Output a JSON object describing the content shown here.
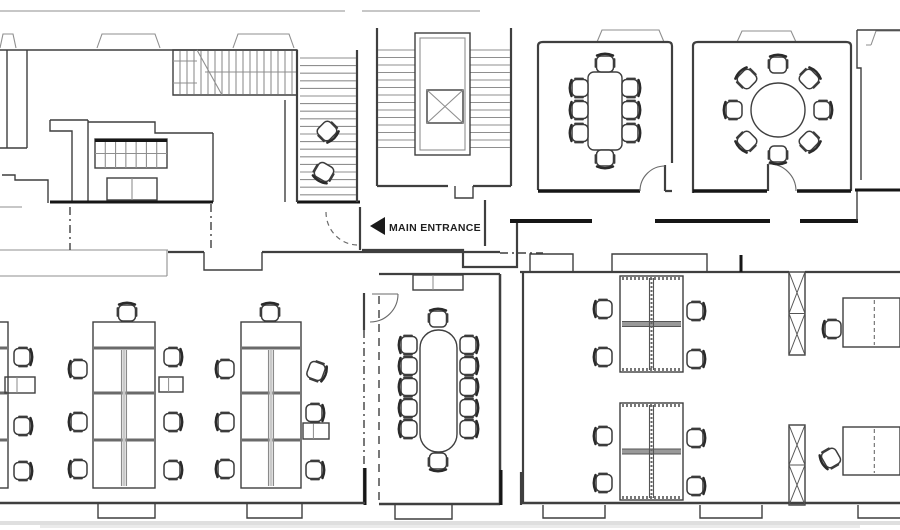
{
  "labels": {
    "main_entrance": "MAIN ENTRANCE"
  },
  "colors": {
    "background": "#ffffff",
    "wall": "#3f3f3f",
    "wall_dark": "#161616",
    "line_light": "#8f8f8f",
    "furniture": "#3c3c3c",
    "text": "#1f1f1f",
    "scan_shadow": "#bfbfbf"
  },
  "floorplan": {
    "chairs": [
      [
        605,
        64,
        0
      ],
      [
        605,
        158,
        180
      ],
      [
        580,
        88,
        270
      ],
      [
        580,
        110,
        270
      ],
      [
        580,
        133,
        270
      ],
      [
        630,
        88,
        90
      ],
      [
        630,
        110,
        90
      ],
      [
        630,
        133,
        90
      ],
      [
        778,
        65,
        0
      ],
      [
        809,
        79,
        45
      ],
      [
        822,
        110,
        90
      ],
      [
        809,
        141,
        135
      ],
      [
        778,
        154,
        180
      ],
      [
        747,
        141,
        225
      ],
      [
        734,
        110,
        270
      ],
      [
        747,
        79,
        315
      ],
      [
        438,
        319,
        0
      ],
      [
        438,
        461,
        180
      ],
      [
        409,
        345,
        270
      ],
      [
        409,
        366,
        270
      ],
      [
        409,
        387,
        270
      ],
      [
        409,
        408,
        270
      ],
      [
        409,
        429,
        270
      ],
      [
        468,
        345,
        90
      ],
      [
        468,
        366,
        90
      ],
      [
        468,
        387,
        90
      ],
      [
        468,
        408,
        90
      ],
      [
        468,
        429,
        90
      ],
      [
        22,
        357,
        90
      ],
      [
        22,
        426,
        90
      ],
      [
        22,
        471,
        90
      ],
      [
        127,
        313,
        0
      ],
      [
        79,
        369,
        270
      ],
      [
        79,
        422,
        270
      ],
      [
        79,
        469,
        270
      ],
      [
        172,
        357,
        90
      ],
      [
        172,
        422,
        90
      ],
      [
        172,
        470,
        90
      ],
      [
        270,
        313,
        0
      ],
      [
        226,
        369,
        270
      ],
      [
        226,
        422,
        270
      ],
      [
        226,
        469,
        270
      ],
      [
        316,
        371,
        110
      ],
      [
        314,
        413,
        90
      ],
      [
        314,
        470,
        90
      ],
      [
        604,
        309,
        270
      ],
      [
        604,
        357,
        270
      ],
      [
        695,
        311,
        90
      ],
      [
        695,
        359,
        90
      ],
      [
        604,
        436,
        270
      ],
      [
        604,
        483,
        270
      ],
      [
        695,
        438,
        90
      ],
      [
        695,
        486,
        90
      ],
      [
        833,
        329,
        270
      ],
      [
        831,
        458,
        240
      ],
      [
        327,
        131,
        135
      ],
      [
        324,
        172,
        210
      ]
    ],
    "desk_banks": [
      {
        "x": -45,
        "y": 322,
        "w": 53,
        "h": 166
      },
      {
        "x": 93,
        "y": 322,
        "w": 62,
        "h": 166
      },
      {
        "x": 241,
        "y": 322,
        "w": 60,
        "h": 166
      }
    ],
    "bank_band_ys": [
      348,
      393,
      440
    ],
    "quad_clusters": [
      {
        "x": 620,
        "y": 276,
        "w": 63,
        "h": 96
      },
      {
        "x": 620,
        "y": 403,
        "w": 63,
        "h": 97
      }
    ],
    "single_desks": [
      {
        "x": 843,
        "y": 298,
        "w": 57,
        "h": 49
      },
      {
        "x": 843,
        "y": 427,
        "w": 57,
        "h": 48
      }
    ],
    "cabinets": [
      {
        "x": 5,
        "y": 377,
        "w": 30,
        "h": 16
      },
      {
        "x": 159,
        "y": 377,
        "w": 24,
        "h": 15
      },
      {
        "x": 303,
        "y": 423,
        "w": 26,
        "h": 16
      },
      {
        "x": 413,
        "y": 275,
        "w": 50,
        "h": 15
      }
    ],
    "tables": {
      "meeting_rect": {
        "x": 588,
        "y": 72,
        "w": 34,
        "h": 78
      },
      "meeting_round": {
        "cx": 778,
        "cy": 110,
        "r": 27
      },
      "boardroom": {
        "x": 420,
        "y": 330,
        "w": 37,
        "h": 122
      },
      "side_table": {
        "x": 107,
        "y": 178,
        "w": 50,
        "h": 22
      },
      "shelving": {
        "x": 95,
        "y": 139,
        "w": 72,
        "h": 29,
        "cols": 7,
        "rows": 2
      }
    },
    "columns": [
      {
        "x": 789,
        "y": 272,
        "w": 16,
        "h": 83
      },
      {
        "x": 789,
        "y": 425,
        "w": 16,
        "h": 80
      }
    ],
    "elevator": {
      "outer": [
        415,
        33,
        55,
        122
      ],
      "inner": [
        420,
        38,
        45,
        112
      ],
      "cab": [
        427,
        90,
        36,
        33
      ]
    },
    "stairs": {
      "well_left": {
        "x1": 378,
        "x2": 415,
        "y0": 50,
        "step": 7.5,
        "n": 14
      },
      "well_right": {
        "x1": 470,
        "x2": 510,
        "y0": 50,
        "step": 7.5,
        "n": 14
      },
      "band_h": {
        "x0": 180,
        "step": 7,
        "n": 17,
        "y1": 51,
        "y2": 94
      },
      "band_v": {
        "y0": 58,
        "step": 7.6,
        "n": 19,
        "x1": 300,
        "x2": 356
      }
    }
  }
}
